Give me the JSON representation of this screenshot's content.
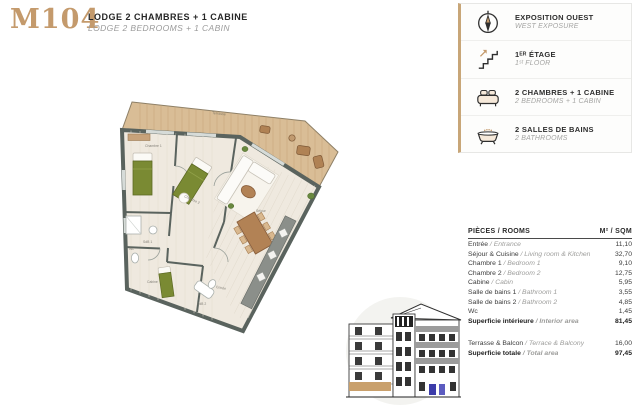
{
  "header": {
    "unit_code": "M104",
    "title_fr": "LODGE 2 CHAMBRES + 1 CABINE",
    "title_en": "LODGE 2 BEDROOMS + 1 CABIN"
  },
  "colors": {
    "accent_gold": "#c49a6c",
    "wall_gray": "#5a635e",
    "terrace_wood": "#d9bd96",
    "floor": "#efe9df",
    "bed_green": "#7a8a33",
    "furniture_brown": "#b28255",
    "elevation_highlight": "#c9a06c",
    "elevation_blue_window": "#3c3caa"
  },
  "info_panel": {
    "items": [
      {
        "icon": "compass-icon",
        "fr": "EXPOSITION OUEST",
        "en": "WEST EXPOSURE"
      },
      {
        "icon": "stairs-icon",
        "fr": "1ᴱᴿ ÉTAGE",
        "en": "1ˢᵗ FLOOR"
      },
      {
        "icon": "bed-icon",
        "fr": "2 CHAMBRES + 1 CABINE",
        "en": "2 BEDROOMS + 1 CABIN"
      },
      {
        "icon": "bathtub-icon",
        "fr": "2 SALLES DE BAINS",
        "en": "2 BATHROOMS"
      }
    ]
  },
  "areas_table": {
    "header": {
      "rooms": "PIÈCES / ROOMS",
      "sqm": "M² / SQM"
    },
    "rows": [
      {
        "fr": "Entrée",
        "en": "Entrance",
        "value": "11,10"
      },
      {
        "fr": "Séjour & Cuisine",
        "en": "Living room & Kitchen",
        "value": "32,70"
      },
      {
        "fr": "Chambre 1",
        "en": "Bedroom 1",
        "value": "9,10"
      },
      {
        "fr": "Chambre 2",
        "en": "Bedroom 2",
        "value": "12,75"
      },
      {
        "fr": "Cabine",
        "en": "Cabin",
        "value": "5,95"
      },
      {
        "fr": "Salle de bains 1",
        "en": "Bathroom 1",
        "value": "3,55"
      },
      {
        "fr": "Salle de bains 2",
        "en": "Bathroom 2",
        "value": "4,85"
      },
      {
        "fr": "Wc",
        "en": "",
        "value": "1,45"
      }
    ],
    "subtotal": {
      "fr": "Superficie intérieure",
      "en": "Interior area",
      "value": "81,45"
    },
    "terrace": {
      "fr": "Terrasse & Balcon",
      "en": "Terrace & Balcony",
      "value": "16,00"
    },
    "total": {
      "fr": "Superficie totale",
      "en": "Total area",
      "value": "97,45"
    }
  },
  "floor_plan": {
    "labels": {
      "terrasse": "Terrasse",
      "chambre1": "Chambre 1",
      "chambre2": "Chambre 2",
      "sejour": "Séjour",
      "entree": "Entrée",
      "cabine": "Cabine",
      "sdb1": "SdB 1",
      "sdb2": "SdB 2",
      "wc": "Wc"
    }
  }
}
